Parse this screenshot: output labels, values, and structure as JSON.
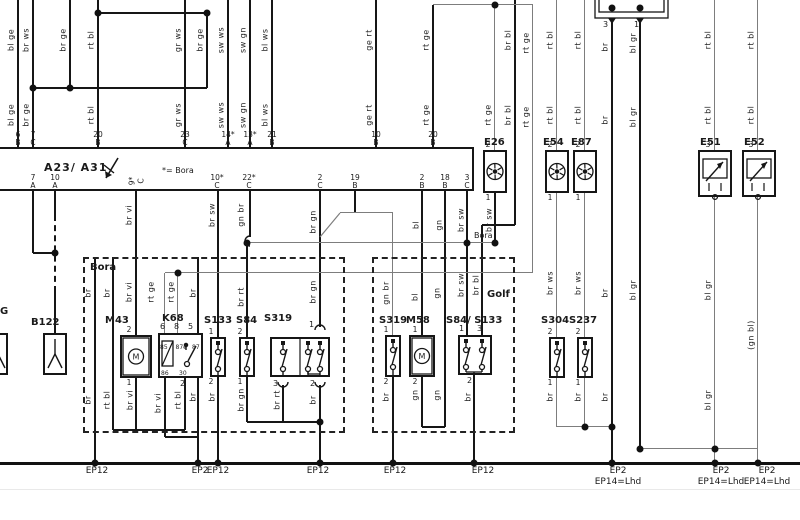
{
  "title_block": {
    "controller_label": "A23/ A31",
    "note": "*= Bora",
    "variant_left": "Bora",
    "variant_right": "Golf",
    "bus_note": "Bora",
    "partial_label": "G"
  },
  "abox": {
    "x": -4,
    "y": 147,
    "w": 478,
    "h": 44,
    "top_pins": [
      {
        "x": 18,
        "n": "6",
        "l": "B"
      },
      {
        "x": 33,
        "n": "7",
        "l": "C"
      },
      {
        "x": 98,
        "n": "20",
        "l": "B"
      },
      {
        "x": 185,
        "n": "23",
        "l": "C"
      },
      {
        "x": 228,
        "n": "14*",
        "l": "A"
      },
      {
        "x": 250,
        "n": "13*",
        "l": "A"
      },
      {
        "x": 272,
        "n": "21",
        "l": "B"
      },
      {
        "x": 376,
        "n": "10",
        "l": "B"
      },
      {
        "x": 433,
        "n": "20",
        "l": "B"
      }
    ],
    "bottom_pins": [
      {
        "x": 33,
        "n": "7",
        "l": "A"
      },
      {
        "x": 55,
        "n": "10",
        "l": "A"
      },
      {
        "x": 136,
        "n": "9*",
        "l": "C",
        "rot": 1
      },
      {
        "x": 217,
        "n": "10*",
        "l": "C"
      },
      {
        "x": 249,
        "n": "22*",
        "l": "C"
      },
      {
        "x": 320,
        "n": "2",
        "l": "C"
      },
      {
        "x": 355,
        "n": "19",
        "l": "B"
      },
      {
        "x": 422,
        "n": "2",
        "l": "B"
      },
      {
        "x": 445,
        "n": "18",
        "l": "B"
      },
      {
        "x": 467,
        "n": "3",
        "l": "C"
      }
    ]
  },
  "components": [
    {
      "id": "B122",
      "label": "B122",
      "lx": 31,
      "ly": 317,
      "x": 43,
      "y": 333,
      "w": 24,
      "h": 42,
      "type": "sens",
      "col": 55
    },
    {
      "id": "G-part",
      "label": "",
      "x": -14,
      "y": 333,
      "w": 22,
      "h": 42,
      "type": "sens",
      "col": -2
    },
    {
      "id": "M43",
      "label": "M43",
      "lx": 105,
      "ly": 315,
      "x": 120,
      "y": 335,
      "w": 32,
      "h": 43,
      "type": "mot",
      "col": 136,
      "tp": "2",
      "bp": "1"
    },
    {
      "id": "K68",
      "label": "K68",
      "lx": 162,
      "ly": 313,
      "x": 158,
      "y": 333,
      "w": 45,
      "h": 45,
      "type": "rel"
    },
    {
      "id": "S133",
      "label": "S133",
      "lx": 204,
      "ly": 315,
      "x": 210,
      "y": 337,
      "w": 16,
      "h": 40,
      "type": "sw",
      "col": 218,
      "tp": "1",
      "bp": "2"
    },
    {
      "id": "S84",
      "label": "S84",
      "lx": 236,
      "ly": 315,
      "x": 239,
      "y": 337,
      "w": 16,
      "h": 40,
      "type": "sw",
      "col": 247,
      "tp": "2",
      "bp": "1"
    },
    {
      "id": "S319",
      "label": "S319",
      "lx": 264,
      "ly": 313,
      "x": 270,
      "y": 337,
      "w": 60,
      "h": 40,
      "type": "sw3"
    },
    {
      "id": "S319-golf",
      "label": "S319",
      "lx": 379,
      "ly": 315,
      "x": 385,
      "y": 335,
      "w": 16,
      "h": 42,
      "type": "sw",
      "col": 393,
      "tp": "1",
      "bp": "2"
    },
    {
      "id": "M58",
      "label": "M58",
      "lx": 406,
      "ly": 315,
      "x": 409,
      "y": 335,
      "w": 26,
      "h": 42,
      "type": "mot",
      "col": 422,
      "tp": "1",
      "bp": "2"
    },
    {
      "id": "S84-S133",
      "label": "S84/ S133",
      "lx": 446,
      "ly": 315,
      "x": 458,
      "y": 335,
      "w": 34,
      "h": 40,
      "type": "sw2"
    },
    {
      "id": "S304",
      "label": "S304",
      "lx": 541,
      "ly": 315,
      "x": 549,
      "y": 337,
      "w": 16,
      "h": 41,
      "type": "sw",
      "col": 557,
      "tp": "2",
      "bp": "1"
    },
    {
      "id": "S237",
      "label": "S237",
      "lx": 569,
      "ly": 315,
      "x": 577,
      "y": 337,
      "w": 16,
      "h": 41,
      "type": "sw",
      "col": 585,
      "tp": "2",
      "bp": "1"
    },
    {
      "id": "E26",
      "label": "E26",
      "lx": 484,
      "ly": 137,
      "x": 483,
      "y": 150,
      "w": 24,
      "h": 43,
      "type": "bulb",
      "col": 495,
      "tp": "2",
      "bp": "1"
    },
    {
      "id": "E54",
      "label": "E54",
      "lx": 543,
      "ly": 137,
      "x": 545,
      "y": 150,
      "w": 24,
      "h": 43,
      "type": "bulb",
      "col": 557,
      "tp": "2",
      "bp": "1"
    },
    {
      "id": "E87",
      "label": "E87",
      "lx": 571,
      "ly": 137,
      "x": 573,
      "y": 150,
      "w": 24,
      "h": 43,
      "type": "bulb",
      "col": 585,
      "tp": "2",
      "bp": "1"
    },
    {
      "id": "E51",
      "label": "E51",
      "lx": 700,
      "ly": 137,
      "x": 698,
      "y": 150,
      "w": 34,
      "h": 47,
      "type": "dim",
      "col": 715,
      "tp": "3"
    },
    {
      "id": "E52",
      "label": "E52",
      "lx": 744,
      "ly": 137,
      "x": 742,
      "y": 150,
      "w": 34,
      "h": 47,
      "type": "dim",
      "col": 758,
      "tp": "3"
    },
    {
      "id": "conn-top",
      "label": "",
      "x": 595,
      "y": -8,
      "w": 73,
      "h": 26,
      "type": "conn"
    }
  ],
  "dashed_boxes": [
    {
      "x": 83,
      "y": 257,
      "w": 262,
      "h": 176
    },
    {
      "x": 372,
      "y": 257,
      "w": 143,
      "h": 176
    }
  ],
  "vwires": [
    {
      "x": 18,
      "y1": 0,
      "y2": 147,
      "c": "k"
    },
    {
      "x": 33,
      "y1": 0,
      "y2": 147,
      "c": "k"
    },
    {
      "x": 70,
      "y1": 0,
      "y2": 88,
      "c": "k"
    },
    {
      "x": 98,
      "y1": 0,
      "y2": 147,
      "c": "k"
    },
    {
      "x": 185,
      "y1": 0,
      "y2": 147,
      "c": "k"
    },
    {
      "x": 207,
      "y1": 13,
      "y2": 88,
      "c": "k"
    },
    {
      "x": 228,
      "y1": 0,
      "y2": 147,
      "c": "k"
    },
    {
      "x": 250,
      "y1": 0,
      "y2": 147,
      "c": "k"
    },
    {
      "x": 272,
      "y1": 0,
      "y2": 147,
      "c": "k"
    },
    {
      "x": 376,
      "y1": 0,
      "y2": 147,
      "c": "k"
    },
    {
      "x": 433,
      "y1": 5,
      "y2": 147,
      "c": "k"
    },
    {
      "x": 495,
      "y1": 5,
      "y2": 150,
      "c": "g"
    },
    {
      "x": 515,
      "y1": 0,
      "y2": 225,
      "c": "k"
    },
    {
      "x": 533,
      "y1": 5,
      "y2": 273,
      "c": "g"
    },
    {
      "x": 557,
      "y1": 0,
      "y2": 150,
      "c": "g"
    },
    {
      "x": 585,
      "y1": 0,
      "y2": 150,
      "c": "g"
    },
    {
      "x": 612,
      "y1": 18,
      "y2": 463,
      "c": "k"
    },
    {
      "x": 640,
      "y1": 18,
      "y2": 449,
      "c": "k"
    },
    {
      "x": 715,
      "y1": 0,
      "y2": 150,
      "c": "g"
    },
    {
      "x": 758,
      "y1": 0,
      "y2": 150,
      "c": "g"
    },
    {
      "x": 33,
      "y1": 191,
      "y2": 253,
      "c": "k"
    },
    {
      "x": 55,
      "y1": 191,
      "y2": 215,
      "c": "k"
    },
    {
      "x": 55,
      "y1": 215,
      "y2": 292,
      "c": "k",
      "d": 1
    },
    {
      "x": 55,
      "y1": 292,
      "y2": 333,
      "c": "k"
    },
    {
      "x": 95,
      "y1": 257,
      "y2": 463,
      "c": "k"
    },
    {
      "x": 113,
      "y1": 257,
      "y2": 430,
      "c": "k"
    },
    {
      "x": 136,
      "y1": 191,
      "y2": 335,
      "c": "k"
    },
    {
      "x": 136,
      "y1": 378,
      "y2": 430,
      "c": "k"
    },
    {
      "x": 165,
      "y1": 273,
      "y2": 333,
      "c": "g"
    },
    {
      "x": 178,
      "y1": 273,
      "y2": 333,
      "c": "g"
    },
    {
      "x": 165,
      "y1": 378,
      "y2": 437,
      "c": "k"
    },
    {
      "x": 185,
      "y1": 378,
      "y2": 430,
      "c": "k"
    },
    {
      "x": 198,
      "y1": 257,
      "y2": 463,
      "c": "k"
    },
    {
      "x": 218,
      "y1": 191,
      "y2": 337,
      "c": "k"
    },
    {
      "x": 218,
      "y1": 377,
      "y2": 463,
      "c": "k"
    },
    {
      "x": 247,
      "y1": 243,
      "y2": 337,
      "c": "k"
    },
    {
      "x": 247,
      "y1": 377,
      "y2": 422,
      "c": "k"
    },
    {
      "x": 250,
      "y1": 191,
      "y2": 237,
      "c": "k"
    },
    {
      "x": 320,
      "y1": 191,
      "y2": 327,
      "c": "k"
    },
    {
      "x": 283,
      "y1": 385,
      "y2": 422,
      "c": "k"
    },
    {
      "x": 320,
      "y1": 385,
      "y2": 463,
      "c": "k"
    },
    {
      "x": 355,
      "y1": 191,
      "y2": 213,
      "c": "k"
    },
    {
      "x": 393,
      "y1": 213,
      "y2": 335,
      "c": "g"
    },
    {
      "x": 393,
      "y1": 377,
      "y2": 463,
      "c": "k"
    },
    {
      "x": 422,
      "y1": 191,
      "y2": 335,
      "c": "k"
    },
    {
      "x": 422,
      "y1": 377,
      "y2": 427,
      "c": "k"
    },
    {
      "x": 445,
      "y1": 191,
      "y2": 427,
      "c": "k"
    },
    {
      "x": 467,
      "y1": 191,
      "y2": 335,
      "c": "k"
    },
    {
      "x": 474,
      "y1": 375,
      "y2": 463,
      "c": "k"
    },
    {
      "x": 482,
      "y1": 225,
      "y2": 335,
      "c": "k"
    },
    {
      "x": 495,
      "y1": 193,
      "y2": 243,
      "c": "k"
    },
    {
      "x": 557,
      "y1": 193,
      "y2": 337,
      "c": "g"
    },
    {
      "x": 557,
      "y1": 378,
      "y2": 427,
      "c": "g"
    },
    {
      "x": 585,
      "y1": 193,
      "y2": 337,
      "c": "g"
    },
    {
      "x": 585,
      "y1": 378,
      "y2": 427,
      "c": "g"
    },
    {
      "x": 715,
      "y1": 197,
      "y2": 463,
      "c": "g"
    },
    {
      "x": 758,
      "y1": 197,
      "y2": 463,
      "c": "g"
    }
  ],
  "hwires": [
    {
      "y": 13,
      "x1": 98,
      "x2": 207,
      "c": "k"
    },
    {
      "y": 5,
      "x1": 433,
      "x2": 533,
      "c": "g"
    },
    {
      "y": 88,
      "x1": 33,
      "x2": 207,
      "c": "k"
    },
    {
      "y": 253,
      "x1": 33,
      "x2": 55,
      "c": "k"
    },
    {
      "y": 243,
      "x1": 250,
      "x2": 495,
      "c": "g"
    },
    {
      "y": 273,
      "x1": 165,
      "x2": 533,
      "c": "g"
    },
    {
      "y": 213,
      "x1": 340,
      "x2": 393,
      "c": "g"
    },
    {
      "y": 225,
      "x1": 482,
      "x2": 515,
      "c": "k"
    },
    {
      "y": 430,
      "x1": 113,
      "x2": 185,
      "c": "k"
    },
    {
      "y": 437,
      "x1": 165,
      "x2": 198,
      "c": "k"
    },
    {
      "y": 422,
      "x1": 247,
      "x2": 320,
      "c": "k"
    },
    {
      "y": 427,
      "x1": 422,
      "x2": 445,
      "c": "k"
    },
    {
      "y": 427,
      "x1": 557,
      "x2": 612,
      "c": "g"
    },
    {
      "y": 449,
      "x1": 640,
      "x2": 758,
      "c": "g"
    }
  ],
  "rail": {
    "y": 463,
    "x1": 0,
    "x2": 800
  },
  "faint_line": {
    "y": 489,
    "x1": 0,
    "x2": 800
  },
  "diags": [
    {
      "x1": 320,
      "y1": 237,
      "x2": 340,
      "y2": 213,
      "c": "g"
    }
  ],
  "dots": [
    [
      33,
      88
    ],
    [
      70,
      88
    ],
    [
      98,
      13
    ],
    [
      207,
      13
    ],
    [
      495,
      5
    ],
    [
      55,
      253
    ],
    [
      247,
      243
    ],
    [
      467,
      243
    ],
    [
      495,
      243
    ],
    [
      178,
      273
    ],
    [
      320,
      422
    ],
    [
      585,
      427
    ],
    [
      612,
      427
    ],
    [
      640,
      449
    ],
    [
      715,
      449
    ],
    [
      612,
      8
    ],
    [
      640,
      8
    ],
    [
      95,
      463
    ],
    [
      198,
      463
    ],
    [
      218,
      463
    ],
    [
      320,
      463
    ],
    [
      393,
      463
    ],
    [
      474,
      463
    ],
    [
      612,
      463
    ],
    [
      715,
      463
    ],
    [
      758,
      463
    ]
  ],
  "curls": [
    {
      "x": 250,
      "y": 241,
      "o": "left"
    },
    {
      "x": 320,
      "y": 330,
      "o": "up"
    },
    {
      "x": 283,
      "y": 382,
      "o": "down"
    },
    {
      "x": 320,
      "y": 382,
      "o": "down"
    }
  ],
  "wire_labels": [
    {
      "x": 11,
      "y": 40,
      "t": "bl ge"
    },
    {
      "x": 11,
      "y": 115,
      "t": "bl ge"
    },
    {
      "x": 26,
      "y": 40,
      "t": "br ws"
    },
    {
      "x": 26,
      "y": 115,
      "t": "br ge"
    },
    {
      "x": 63,
      "y": 40,
      "t": "br ge"
    },
    {
      "x": 91,
      "y": 40,
      "t": "rt bl"
    },
    {
      "x": 91,
      "y": 115,
      "t": "rt bl"
    },
    {
      "x": 178,
      "y": 40,
      "t": "gr ws"
    },
    {
      "x": 178,
      "y": 115,
      "t": "gr ws"
    },
    {
      "x": 200,
      "y": 40,
      "t": "br ge"
    },
    {
      "x": 221,
      "y": 40,
      "t": "sw ws"
    },
    {
      "x": 221,
      "y": 115,
      "t": "sw ws"
    },
    {
      "x": 243,
      "y": 40,
      "t": "sw gn"
    },
    {
      "x": 243,
      "y": 115,
      "t": "sw gn"
    },
    {
      "x": 265,
      "y": 40,
      "t": "bl ws"
    },
    {
      "x": 265,
      "y": 115,
      "t": "bl ws"
    },
    {
      "x": 369,
      "y": 40,
      "t": "ge rt"
    },
    {
      "x": 369,
      "y": 115,
      "t": "ge rt"
    },
    {
      "x": 426,
      "y": 40,
      "t": "rt ge"
    },
    {
      "x": 426,
      "y": 115,
      "t": "rt ge"
    },
    {
      "x": 488,
      "y": 115,
      "t": "rt ge"
    },
    {
      "x": 508,
      "y": 40,
      "t": "br bl"
    },
    {
      "x": 508,
      "y": 115,
      "t": "br bl"
    },
    {
      "x": 526,
      "y": 43,
      "t": "rt ge"
    },
    {
      "x": 526,
      "y": 117,
      "t": "rt ge"
    },
    {
      "x": 550,
      "y": 40,
      "t": "rt bl"
    },
    {
      "x": 550,
      "y": 115,
      "t": "rt bl"
    },
    {
      "x": 578,
      "y": 40,
      "t": "rt bl"
    },
    {
      "x": 578,
      "y": 115,
      "t": "rt bl"
    },
    {
      "x": 605,
      "y": 47,
      "t": "br"
    },
    {
      "x": 605,
      "y": 120,
      "t": "br"
    },
    {
      "x": 605,
      "y": 293,
      "t": "br"
    },
    {
      "x": 605,
      "y": 397,
      "t": "br"
    },
    {
      "x": 633,
      "y": 43,
      "t": "bl gr"
    },
    {
      "x": 633,
      "y": 117,
      "t": "bl gr"
    },
    {
      "x": 633,
      "y": 290,
      "t": "bl gr"
    },
    {
      "x": 708,
      "y": 40,
      "t": "rt bl"
    },
    {
      "x": 708,
      "y": 115,
      "t": "rt bl"
    },
    {
      "x": 708,
      "y": 290,
      "t": "bl gr"
    },
    {
      "x": 708,
      "y": 400,
      "t": "bl gr"
    },
    {
      "x": 751,
      "y": 40,
      "t": "rt bl"
    },
    {
      "x": 751,
      "y": 115,
      "t": "rt bl"
    },
    {
      "x": 751,
      "y": 335,
      "t": "(gn bl)"
    },
    {
      "x": 129,
      "y": 215,
      "t": "br vi"
    },
    {
      "x": 129,
      "y": 292,
      "t": "br vi"
    },
    {
      "x": 88,
      "y": 293,
      "t": "br"
    },
    {
      "x": 88,
      "y": 400,
      "t": "br"
    },
    {
      "x": 107,
      "y": 293,
      "t": "br"
    },
    {
      "x": 107,
      "y": 400,
      "t": "rt bl"
    },
    {
      "x": 130,
      "y": 400,
      "t": "br vi"
    },
    {
      "x": 158,
      "y": 403,
      "t": "br vi"
    },
    {
      "x": 151,
      "y": 292,
      "t": "rt ge"
    },
    {
      "x": 171,
      "y": 292,
      "t": "rt ge"
    },
    {
      "x": 178,
      "y": 400,
      "t": "rt bl"
    },
    {
      "x": 193,
      "y": 293,
      "t": "br"
    },
    {
      "x": 193,
      "y": 397,
      "t": "br"
    },
    {
      "x": 212,
      "y": 215,
      "t": "br sw"
    },
    {
      "x": 212,
      "y": 397,
      "t": "br"
    },
    {
      "x": 241,
      "y": 215,
      "t": "gn br"
    },
    {
      "x": 241,
      "y": 297,
      "t": "br rt"
    },
    {
      "x": 241,
      "y": 400,
      "t": "br gn"
    },
    {
      "x": 313,
      "y": 222,
      "t": "br gn"
    },
    {
      "x": 313,
      "y": 292,
      "t": "br gn"
    },
    {
      "x": 277,
      "y": 400,
      "t": "br rt"
    },
    {
      "x": 313,
      "y": 400,
      "t": "br"
    },
    {
      "x": 386,
      "y": 293,
      "t": "gn br"
    },
    {
      "x": 386,
      "y": 397,
      "t": "br"
    },
    {
      "x": 416,
      "y": 225,
      "t": "bl"
    },
    {
      "x": 415,
      "y": 297,
      "t": "bl"
    },
    {
      "x": 415,
      "y": 395,
      "t": "gn"
    },
    {
      "x": 439,
      "y": 225,
      "t": "gn"
    },
    {
      "x": 437,
      "y": 293,
      "t": "gn"
    },
    {
      "x": 437,
      "y": 395,
      "t": "gn"
    },
    {
      "x": 461,
      "y": 220,
      "t": "br sw"
    },
    {
      "x": 461,
      "y": 285,
      "t": "br sw"
    },
    {
      "x": 476,
      "y": 285,
      "t": "br bl"
    },
    {
      "x": 468,
      "y": 397,
      "t": "br"
    },
    {
      "x": 489,
      "y": 220,
      "t": "br sw"
    },
    {
      "x": 550,
      "y": 283,
      "t": "br ws"
    },
    {
      "x": 550,
      "y": 397,
      "t": "br"
    },
    {
      "x": 578,
      "y": 283,
      "t": "br ws"
    },
    {
      "x": 578,
      "y": 397,
      "t": "br"
    }
  ],
  "texts": [
    {
      "x": 44,
      "y": 161,
      "t": "A23/ A31",
      "cls": "big"
    },
    {
      "x": 162,
      "y": 166,
      "t": "*= Bora",
      "cls": ""
    },
    {
      "x": 90,
      "y": 262,
      "t": "Bora",
      "cls": "b"
    },
    {
      "x": 487,
      "y": 289,
      "t": "Golf",
      "cls": "b"
    },
    {
      "x": 474,
      "y": 231,
      "t": "Bora",
      "cls": ""
    },
    {
      "x": 0,
      "y": 306,
      "t": "G",
      "cls": "b"
    },
    {
      "x": 603,
      "y": 20,
      "t": "3",
      "cls": ""
    },
    {
      "x": 634,
      "y": 20,
      "t": "1",
      "cls": ""
    },
    {
      "x": 309,
      "y": 320,
      "t": "1",
      "cls": ""
    },
    {
      "x": 273,
      "y": 379,
      "t": "3",
      "cls": ""
    },
    {
      "x": 310,
      "y": 379,
      "t": "2",
      "cls": ""
    },
    {
      "x": 459,
      "y": 324,
      "t": "1",
      "cls": ""
    },
    {
      "x": 477,
      "y": 324,
      "t": "3",
      "cls": ""
    },
    {
      "x": 467,
      "y": 376,
      "t": "2",
      "cls": ""
    },
    {
      "x": 160,
      "y": 322,
      "t": "6",
      "cls": ""
    },
    {
      "x": 174,
      "y": 322,
      "t": "8",
      "cls": ""
    },
    {
      "x": 188,
      "y": 322,
      "t": "5",
      "cls": ""
    },
    {
      "x": 180,
      "y": 379,
      "t": "2",
      "cls": ""
    }
  ],
  "relay_terms": {
    "t1": "85",
    "t2": "87e",
    "t3": "87",
    "b1": "86",
    "b2": "30"
  },
  "grounds": [
    {
      "x": 97,
      "t": "EP12"
    },
    {
      "x": 200,
      "t": "EP2"
    },
    {
      "x": 218,
      "t": "EP12"
    },
    {
      "x": 318,
      "t": "EP12"
    },
    {
      "x": 395,
      "t": "EP12"
    },
    {
      "x": 483,
      "t": "EP12"
    },
    {
      "x": 618,
      "t": "EP2",
      "t2": "EP14=Lhd"
    },
    {
      "x": 721,
      "t": "EP2",
      "t2": "EP14=Lhd"
    },
    {
      "x": 767,
      "t": "EP2",
      "t2": "EP14=Lhd"
    }
  ],
  "colors": {
    "line": "#161616",
    "gray": "#7d7d7d",
    "bg": "#ffffff"
  }
}
